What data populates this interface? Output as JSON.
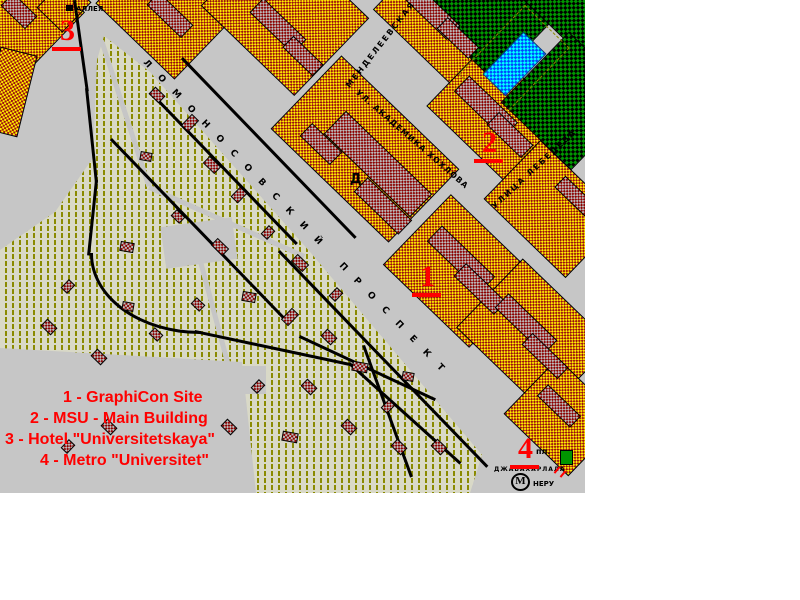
{
  "map": {
    "width": 585,
    "height": 493,
    "colors": {
      "road_gray": "#c6c6c6",
      "block_yellow": "#ffee00",
      "block_maroon": "#9b0e0e",
      "park_green": "#009600",
      "pond_blue": "#0048ff",
      "pond_cyan": "#00ffff",
      "hatch_bg": "#d9d9c7",
      "hatch_line": "#8a8a00",
      "marker_red": "#ff0000",
      "outside": "#ffffff"
    },
    "streets": [
      {
        "id": "lomonosovsky-prospekt",
        "name": "ЛОМОНОСОВСКИЙ ПРОСПЕКТ"
      },
      {
        "id": "mendeleevskaya",
        "name": "МЕНДЕЛЕЕВСКАЯ"
      },
      {
        "id": "akademika-khokhlova",
        "name": "УЛ. АКАДЕМИКА ХОХЛОВА"
      },
      {
        "id": "lebedeva",
        "name": "УЛИЦА ЛЕБЕДЕВА"
      },
      {
        "id": "alleya-partial",
        "name": "АЛЛЕЯ"
      }
    ],
    "labels": {
      "square_abbr": "пл.",
      "square_name": "ДЖАВАХАРЛАЛА",
      "square_name2": "НЕРУ",
      "metro_letter": "М",
      "building_symbol": "Д"
    },
    "markers": [
      {
        "label": "1"
      },
      {
        "label": "2"
      },
      {
        "label": "3"
      },
      {
        "label": "4"
      }
    ],
    "legend": {
      "items": [
        "1 - GraphiCon Site",
        "2 - MSU - Main Building",
        "3 - Hotel \"Universitetskaya\"",
        "4 - Metro \"Universitet\""
      ]
    }
  }
}
